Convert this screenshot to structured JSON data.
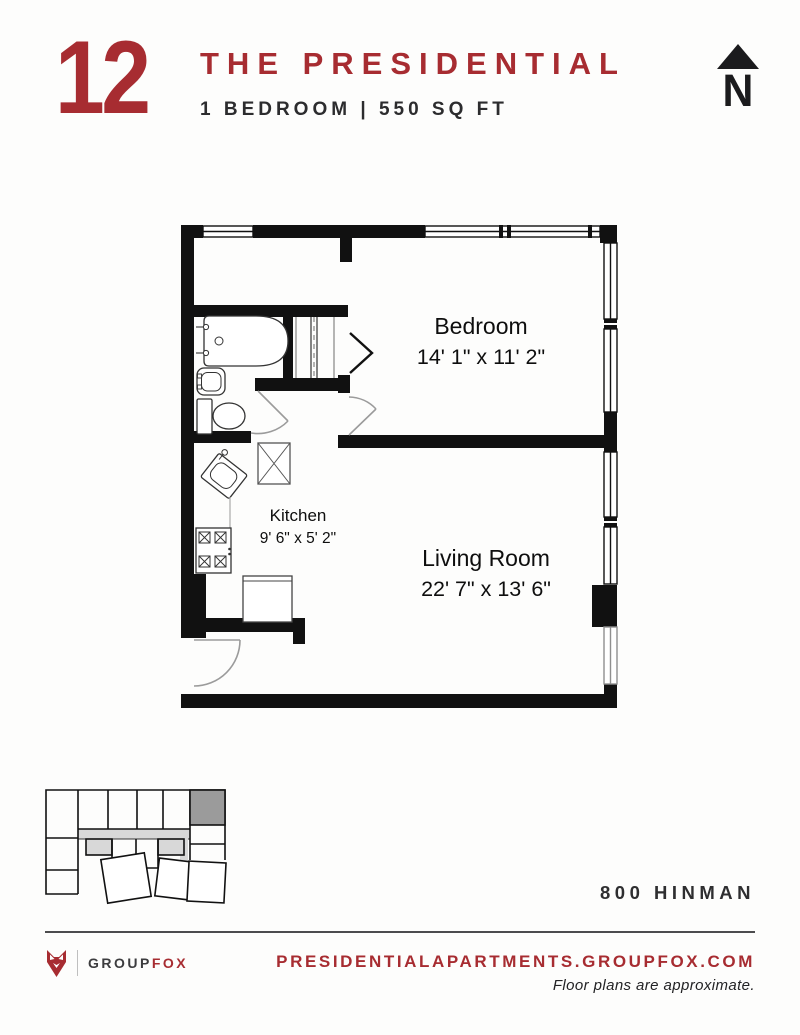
{
  "header": {
    "unit_number": "12",
    "building_name": "THE PRESIDENTIAL",
    "unit_specs": "1 BEDROOM | 550 SQ FT",
    "north_label": "N"
  },
  "floor_plan": {
    "rooms": [
      {
        "name": "Bedroom",
        "dimensions": "14' 1\" x 11' 2\""
      },
      {
        "name": "Kitchen",
        "dimensions": "9' 6\" x 5' 2\""
      },
      {
        "name": "Living Room",
        "dimensions": "22' 7\" x 13' 6\""
      }
    ]
  },
  "address": "800 HINMAN",
  "footer": {
    "logo": {
      "group": "GROUP",
      "fox": "FOX"
    },
    "website": "PRESIDENTIALAPARTMENTS.GROUPFOX.COM",
    "disclaimer": "Floor plans are approximate."
  },
  "colors": {
    "accent_red": "#a72c31",
    "text_dark": "#2c2c2e",
    "wall_black": "#111111",
    "keyplan_unit_fill": "#9b9b9b",
    "keyplan_corridor_fill": "#d8d8d8"
  }
}
